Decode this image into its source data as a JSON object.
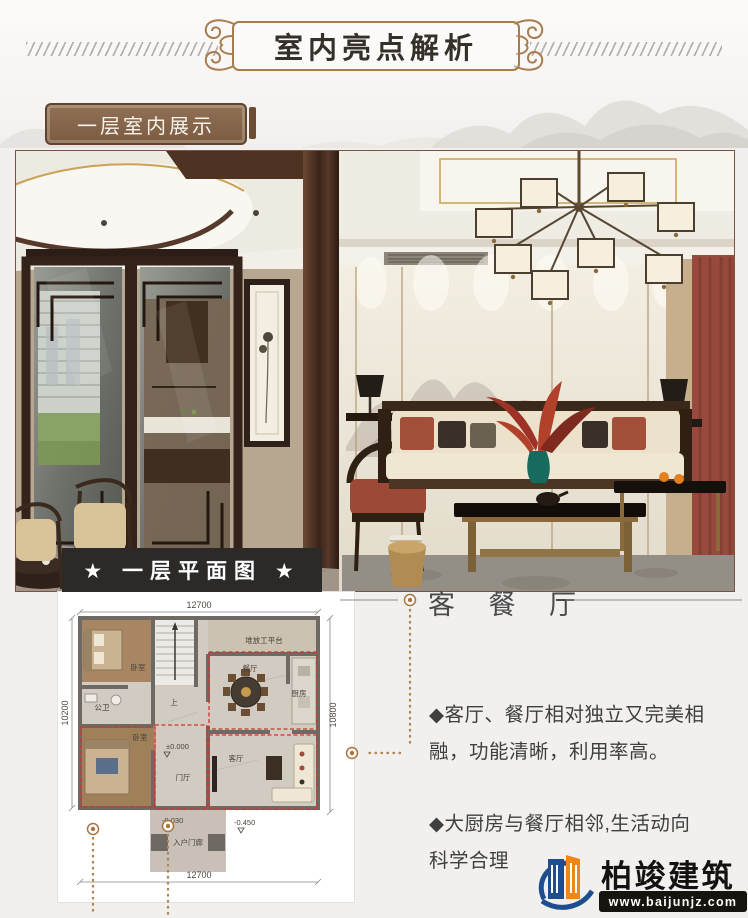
{
  "header": {
    "title": "室内亮点解析"
  },
  "tag": {
    "label": "一层室内展示"
  },
  "plan_banner": {
    "label": "★ 一层平面图 ★"
  },
  "floor_plan": {
    "dim_top": "12700",
    "dim_bottom": "12700",
    "dim_left": "10200",
    "dim_right": "10800",
    "rooms": {
      "bedroom_top": "卧室",
      "bath": "公卫",
      "bedroom_bottom": "卧室",
      "foyer": "门厅",
      "living": "客厅",
      "dining": "餐厅",
      "kitchen": "厨房",
      "platform": "堆放工平台",
      "stairs_up": "上",
      "porch": "入户门廊"
    },
    "levels": {
      "zero": "±0.000",
      "porch": "-0.030",
      "outside": "-0.450"
    }
  },
  "callout": {
    "heading": "客 餐 厅",
    "bullets": [
      "◆客厅、餐厅相对独立又完美相融，功能清晰，利用率高。",
      "◆大厨房与餐厅相邻,生活动向科学合理"
    ]
  },
  "logo": {
    "name": "柏竣建筑",
    "website": "www.baijunjz.com"
  },
  "colors": {
    "accent_bronze": "#a87c4f",
    "banner_black": "#2b2a29",
    "dash_red": "#d0342c",
    "leader": "#b08652",
    "logo_blue": "#1d4e8f",
    "logo_orange": "#f08519"
  }
}
